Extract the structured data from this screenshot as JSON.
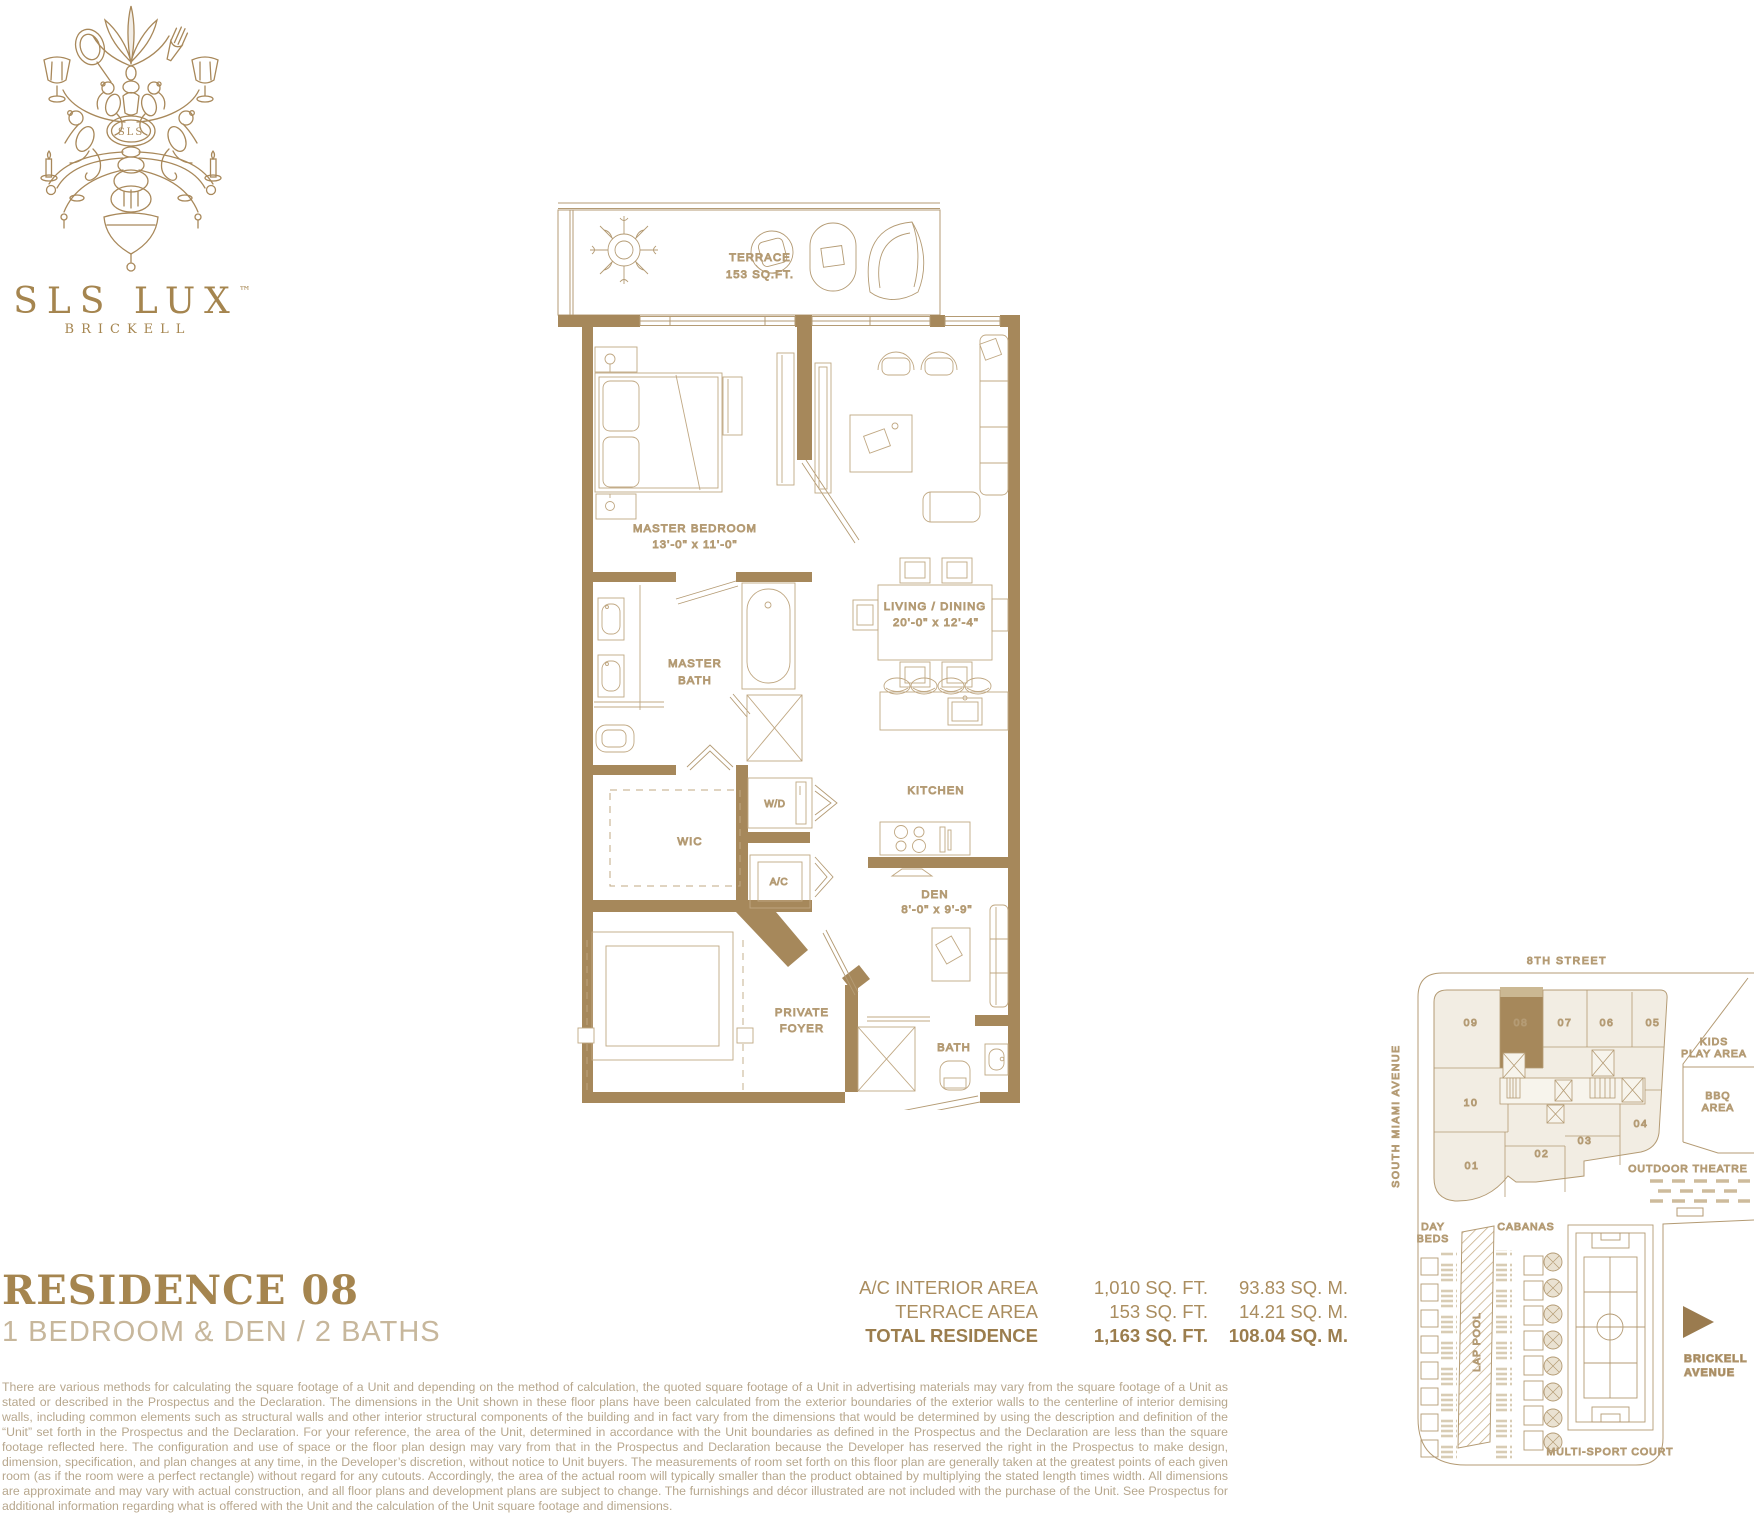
{
  "colors": {
    "wall_gold": "#A6885B",
    "line_gold": "#B49B74",
    "furniture_gold": "#C0A883",
    "label_gold": "#A8895E",
    "title_gold": "#A5854F",
    "muted_gold": "#C7B79C",
    "beige_fill": "#F2EDE3",
    "highlight_unit": "#A6885B",
    "disclaimer_text": "#B7A78D"
  },
  "logo": {
    "brand": "SLS LUX",
    "tm": "™",
    "monogram": "SLS",
    "city": "BRICKELL"
  },
  "residence": {
    "title": "RESIDENCE 08",
    "subtitle": "1 BEDROOM & DEN / 2 BATHS"
  },
  "floorplan": {
    "terrace_l1": "TERRACE",
    "terrace_l2": "153 SQ.FT.",
    "master_bedroom_l1": "MASTER BEDROOM",
    "master_bedroom_l2": "13'-0\" x 11'-0\"",
    "living_l1": "LIVING / DINING",
    "living_l2": "20'-0\" x 12'-4\"",
    "master_bath_l1": "MASTER",
    "master_bath_l2": "BATH",
    "wic": "WIC",
    "wd": "W/D",
    "ac": "A/C",
    "kitchen": "KITCHEN",
    "den_l1": "DEN",
    "den_l2": "8'-0\" x 9'-9\"",
    "bath": "BATH",
    "foyer_l1": "PRIVATE",
    "foyer_l2": "FOYER"
  },
  "area_table": {
    "rows": [
      {
        "label": "A/C INTERIOR AREA",
        "sqft": "1,010 SQ. FT.",
        "sqm": "93.83 SQ. M."
      },
      {
        "label": "TERRACE AREA",
        "sqft": "153 SQ. FT.",
        "sqm": "14.21 SQ. M."
      },
      {
        "label": "TOTAL RESIDENCE",
        "sqft": "1,163 SQ. FT.",
        "sqm": "108.04 SQ. M."
      }
    ]
  },
  "keyplan": {
    "street_top": "8TH STREET",
    "street_left": "SOUTH MIAMI AVENUE",
    "units": [
      "09",
      "08",
      "07",
      "06",
      "05",
      "10",
      "01",
      "02",
      "03",
      "04"
    ],
    "highlighted_unit": "08",
    "kids_l1": "KIDS",
    "kids_l2": "PLAY AREA",
    "bbq_l1": "BBQ",
    "bbq_l2": "AREA",
    "outdoor_theatre": "OUTDOOR THEATRE",
    "day_l1": "DAY",
    "day_l2": "BEDS",
    "cabanas": "CABANAS",
    "lap_pool": "LAP POOL",
    "court": "MULTI-SPORT COURT",
    "brickell_l1": "BRICKELL",
    "brickell_l2": "AVENUE"
  },
  "disclaimer": "There are various methods for calculating the square footage of a Unit and depending on the method of calculation, the quoted square footage of a Unit in advertising materials may vary from the square footage of a Unit as stated or described in the Prospectus and the Declaration.  The dimensions in the Unit shown in these floor plans have been calculated from the exterior boundaries of the exterior walls to the centerline of interior demising walls, including common elements such as structural walls and other interior structural components of the building and in fact vary from the dimensions that would be determined by using the description and definition of the “Unit” set forth in the Prospectus and the Declaration.  For your reference, the area of the Unit, determined in accordance with the Unit boundaries as defined in the Prospectus and the Declaration are less than the square footage reflected here.  The configuration and use of space or the floor plan design may vary from that in the Prospectus and Declaration because the Developer has reserved the right in the Prospectus to make design, dimension, specification, and plan changes at any time, in the Developer’s discretion, without notice to Unit buyers.  The measurements of room set forth on this floor plan are generally taken at the greatest points of each given room (as if the room were a perfect rectangle) without regard for any cutouts.  Accordingly, the area of the actual room will typically smaller than the product obtained by multiplying the stated length times width.  All dimensions are approximate and may vary with actual construction, and all floor plans and development plans are subject to change.  The furnishings and décor illustrated are not included with the purchase of the Unit.  See Prospectus for additional information regarding what is offered with the Unit and the calculation of the Unit square footage and dimensions."
}
